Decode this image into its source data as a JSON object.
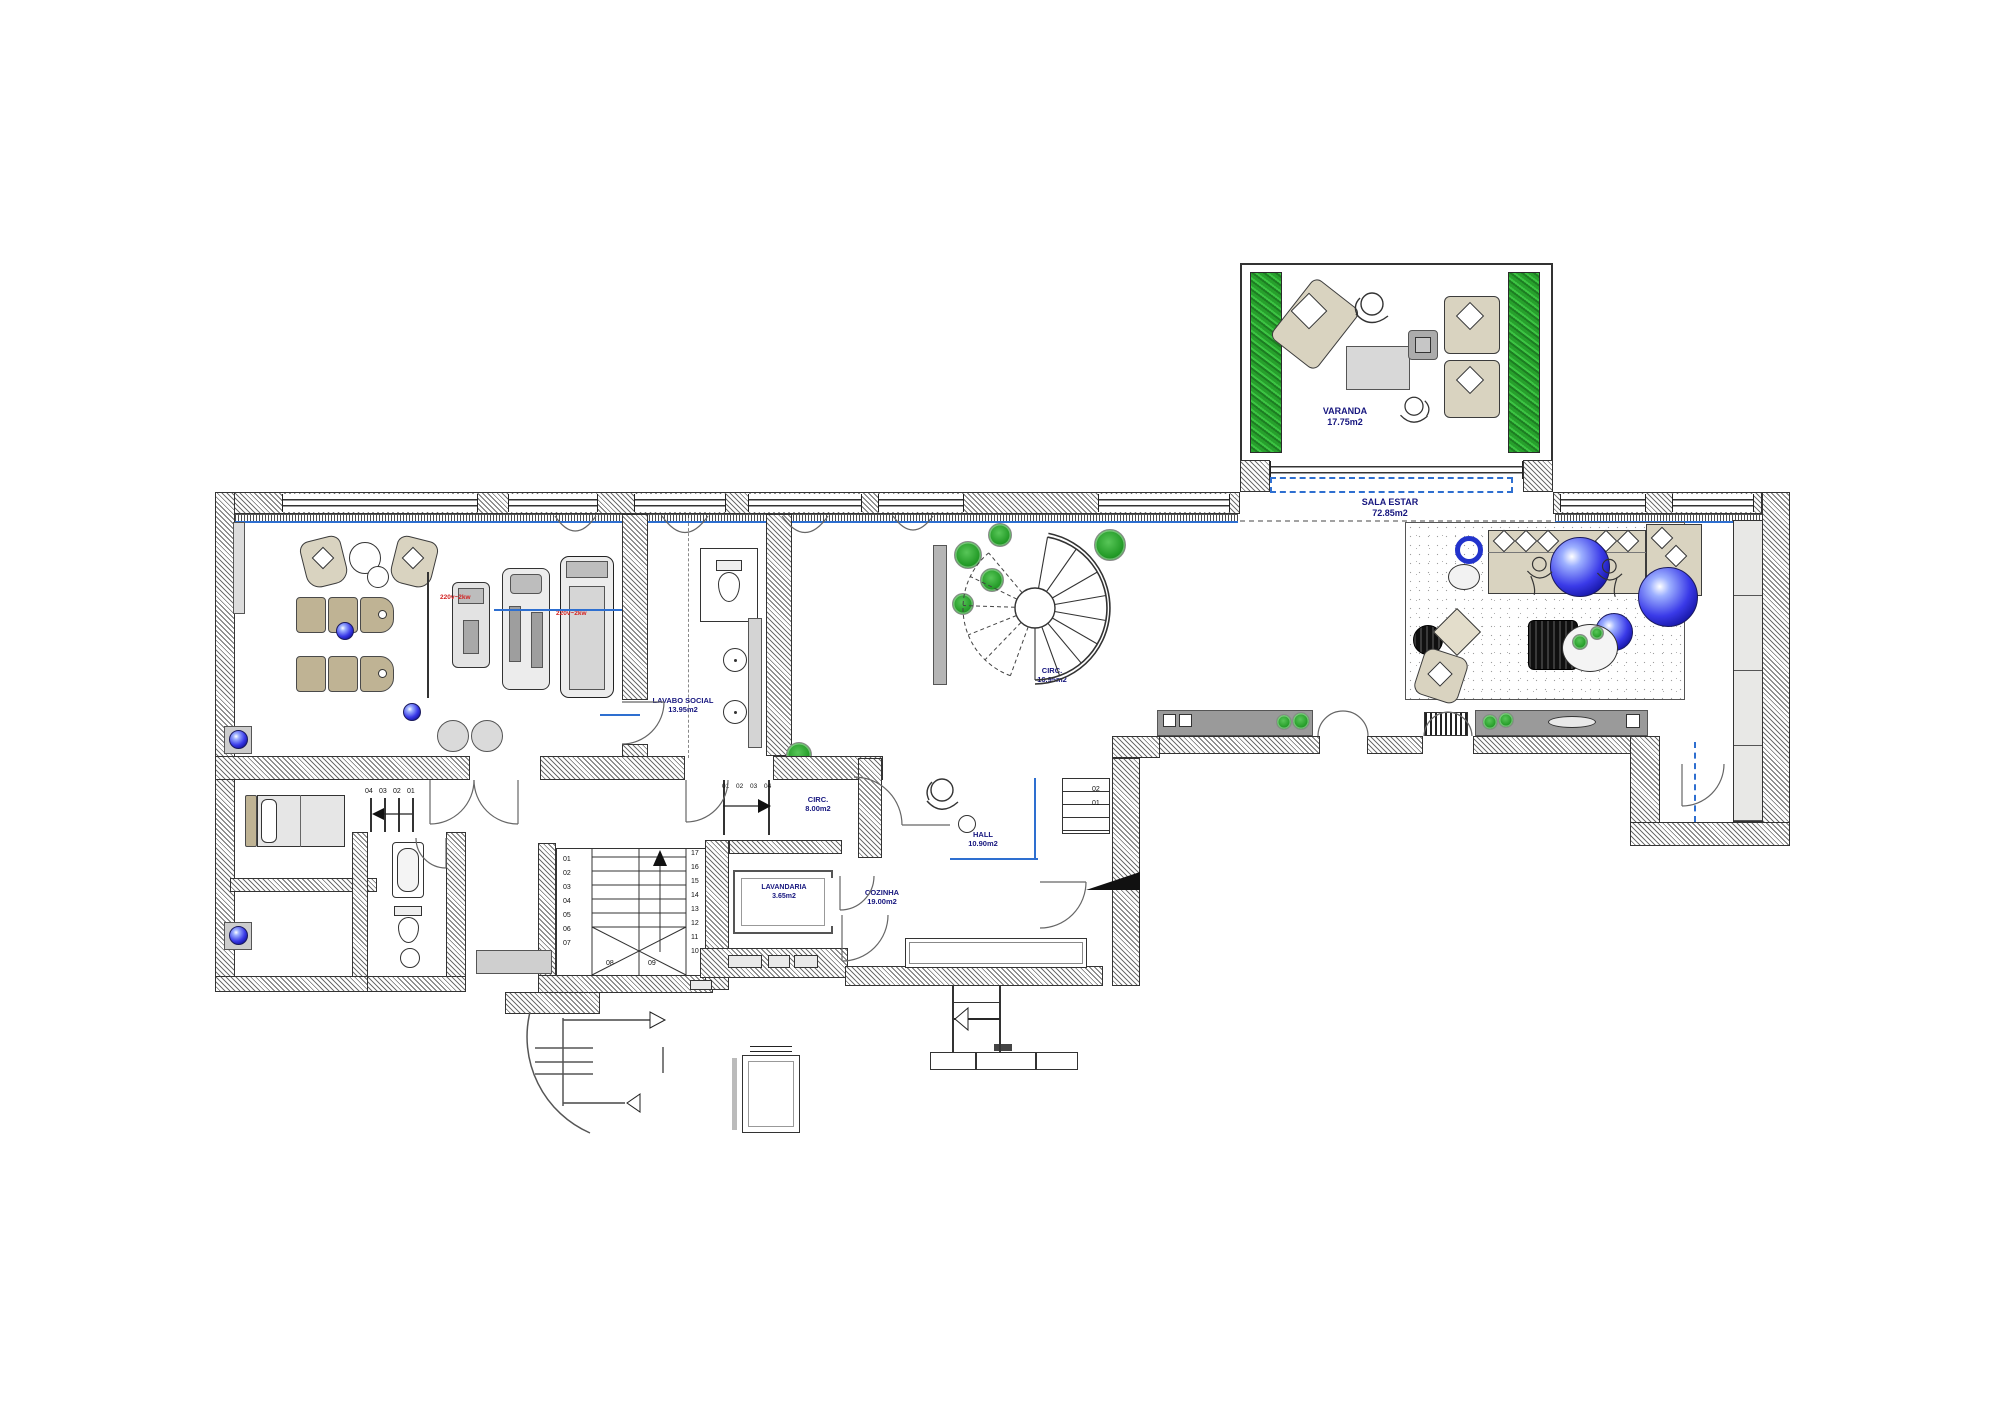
{
  "plan": {
    "rooms": {
      "varanda": {
        "name": "VARANDA",
        "area": "17.75m2"
      },
      "sala_estar": {
        "name": "SALA ESTAR",
        "area": "72.85m2"
      },
      "lavabo_social": {
        "name": "LAVABO SOCIAL",
        "area": "13.95m2"
      },
      "circ_stair": {
        "name": "CIRC.",
        "area": "16.95m2"
      },
      "circ_hall": {
        "name": "CIRC.",
        "area": "8.00m2"
      },
      "hall": {
        "name": "HALL",
        "area": "10.90m2"
      },
      "lavandaria": {
        "name": "LAVANDARIA",
        "area": "3.65m2"
      },
      "cozinha": {
        "name": "COZINHA",
        "area": "19.00m2"
      }
    },
    "power": {
      "machine_left": "220v~2kw",
      "machine_right": "220v~2kw"
    },
    "stairs": {
      "main_left": [
        "01",
        "02",
        "03",
        "04",
        "05",
        "06",
        "07"
      ],
      "main_right": [
        "17",
        "16",
        "15",
        "14",
        "13",
        "12",
        "11",
        "10"
      ],
      "main_winders": [
        "08",
        "09"
      ],
      "circ_steps": [
        "01",
        "02",
        "03",
        "04"
      ],
      "bedroom_steps": [
        "04",
        "03",
        "02",
        "01"
      ],
      "hall_steps": [
        "02",
        "01"
      ]
    },
    "colors": {
      "accent_blue": "#2e6fd0",
      "label_navy": "#17177f",
      "power_red": "#d22222",
      "plant_green": "#239b27"
    }
  }
}
